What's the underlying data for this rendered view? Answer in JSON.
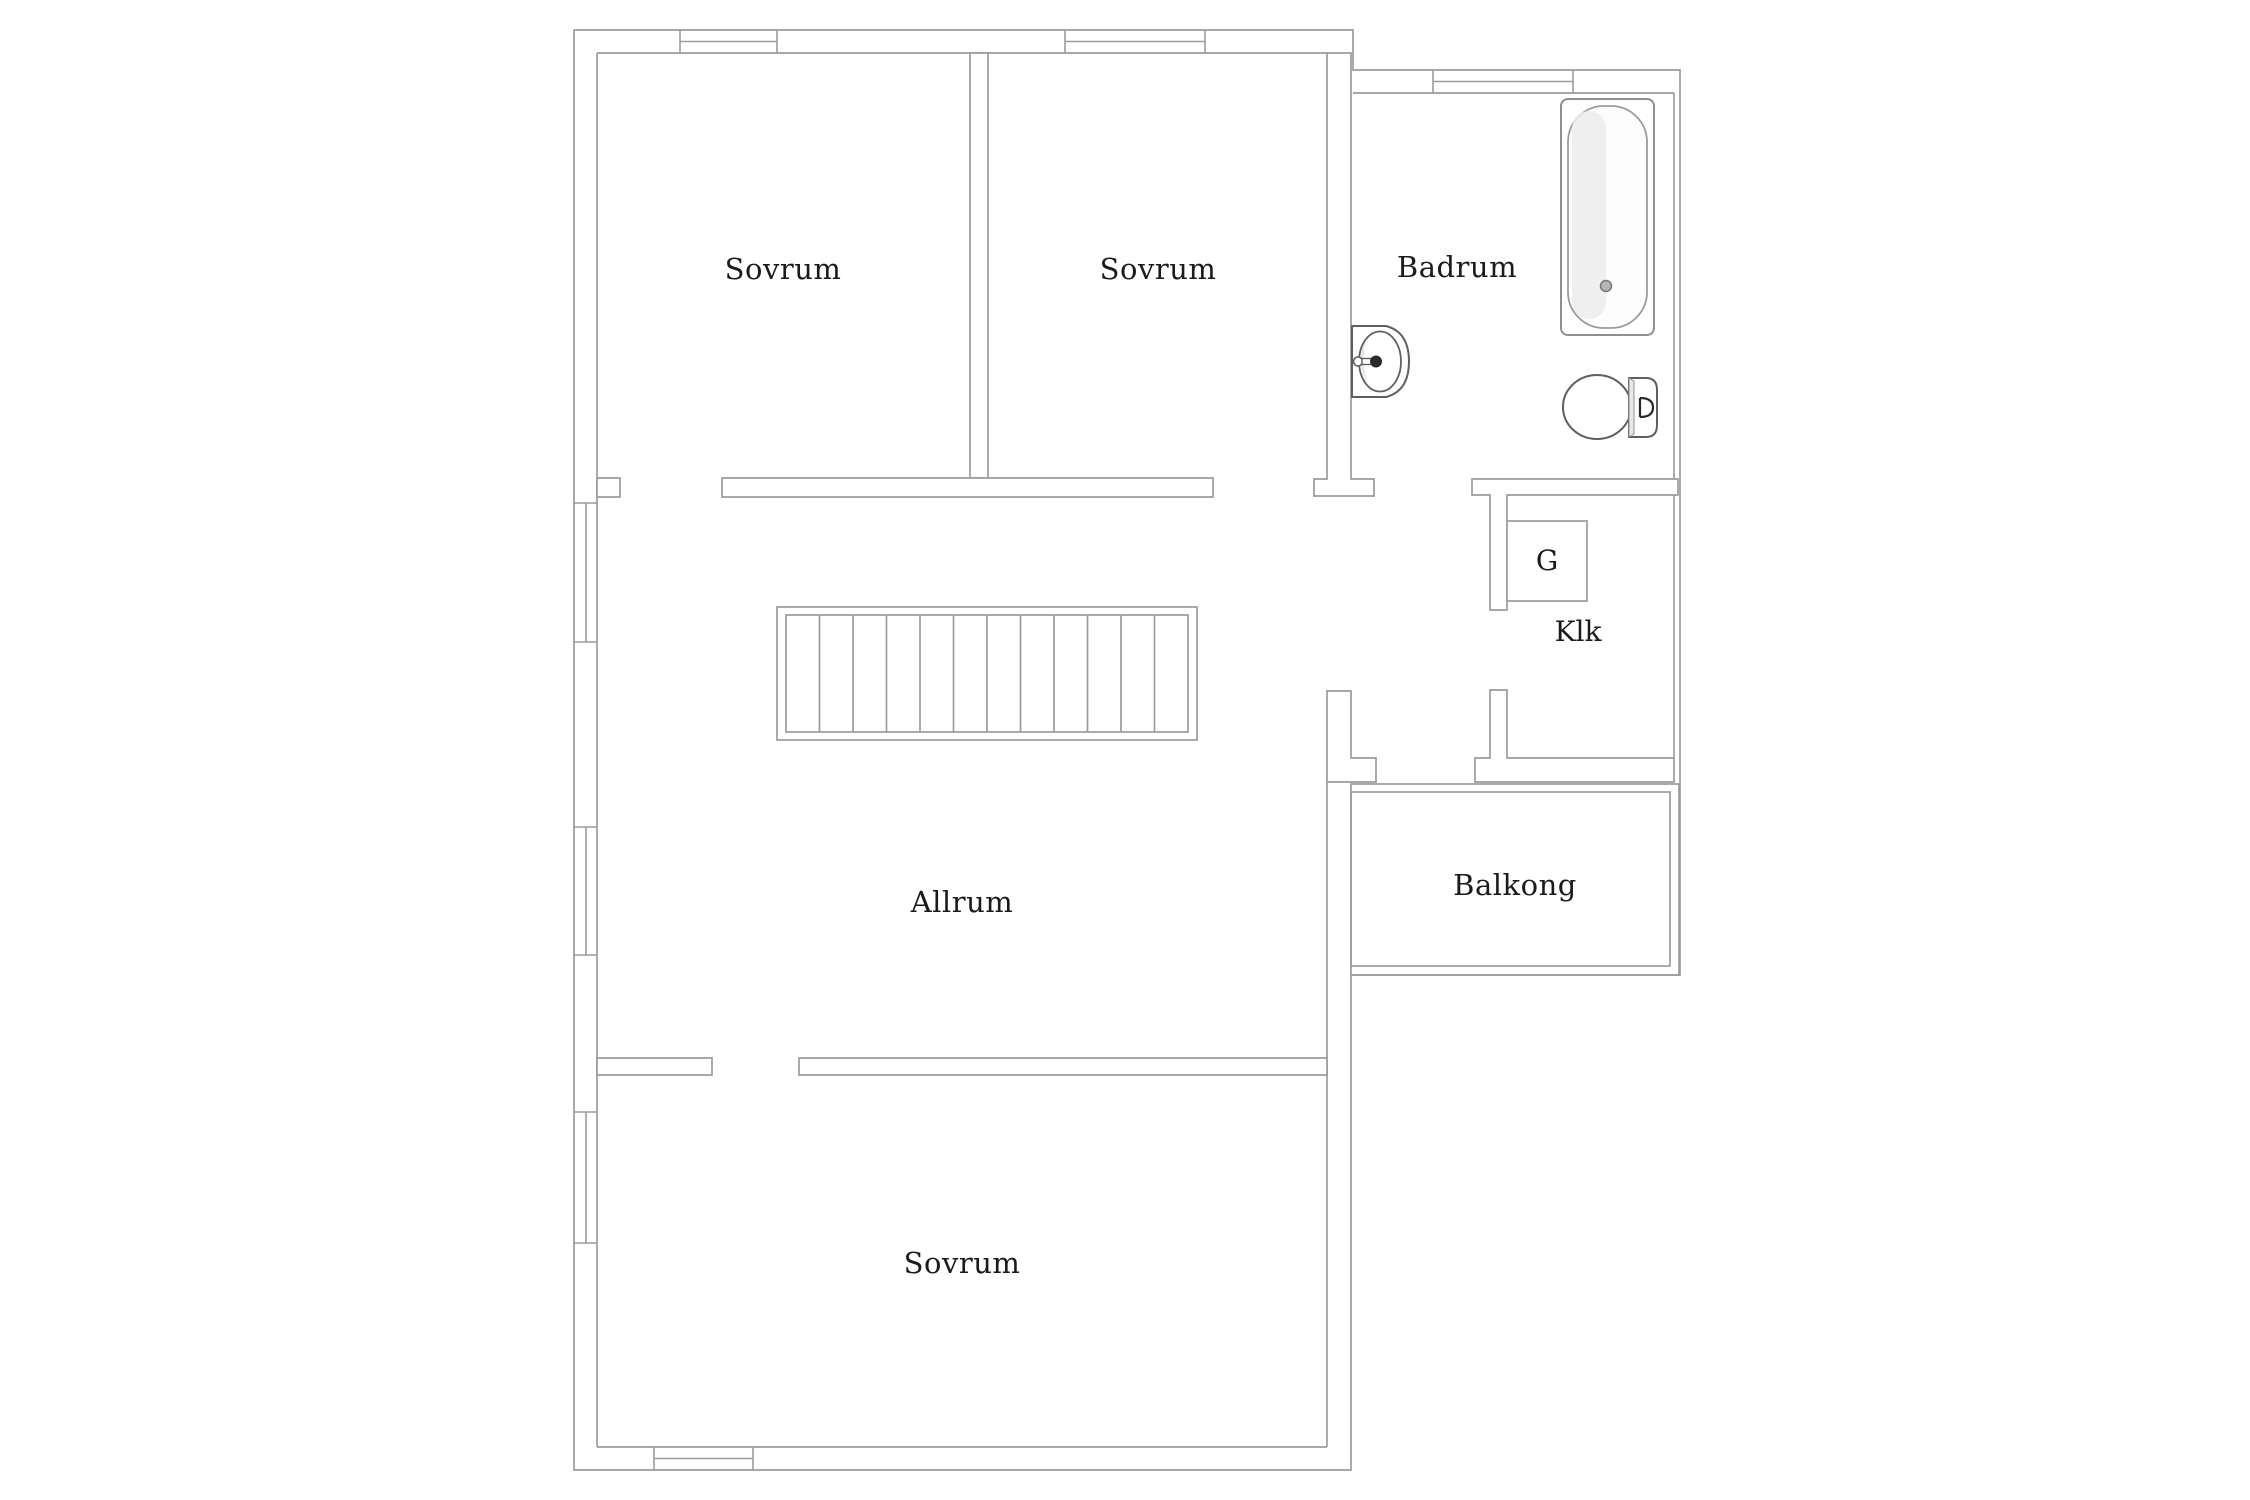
{
  "plan": {
    "title": "Floor plan – upper level",
    "colors": {
      "background": "#ffffff",
      "wall_line": "#9c9c9c",
      "fixture_line": "#8f8f8f",
      "fixture_dark": "#3a3a3a",
      "shading": "#ececec",
      "text": "#1b1b1b"
    },
    "rooms": [
      {
        "id": "sovrum-1",
        "label": "Sovrum"
      },
      {
        "id": "sovrum-2",
        "label": "Sovrum"
      },
      {
        "id": "badrum",
        "label": "Badrum"
      },
      {
        "id": "garderob",
        "label": "G"
      },
      {
        "id": "klk",
        "label": "Klk"
      },
      {
        "id": "allrum",
        "label": "Allrum"
      },
      {
        "id": "balkong",
        "label": "Balkong"
      },
      {
        "id": "sovrum-3",
        "label": "Sovrum"
      }
    ],
    "fixtures": [
      "bathtub",
      "sink",
      "toilet",
      "stairs",
      "wardrobe-box",
      "balcony-railing"
    ],
    "window_count": 7,
    "door_opening_count": 5
  }
}
